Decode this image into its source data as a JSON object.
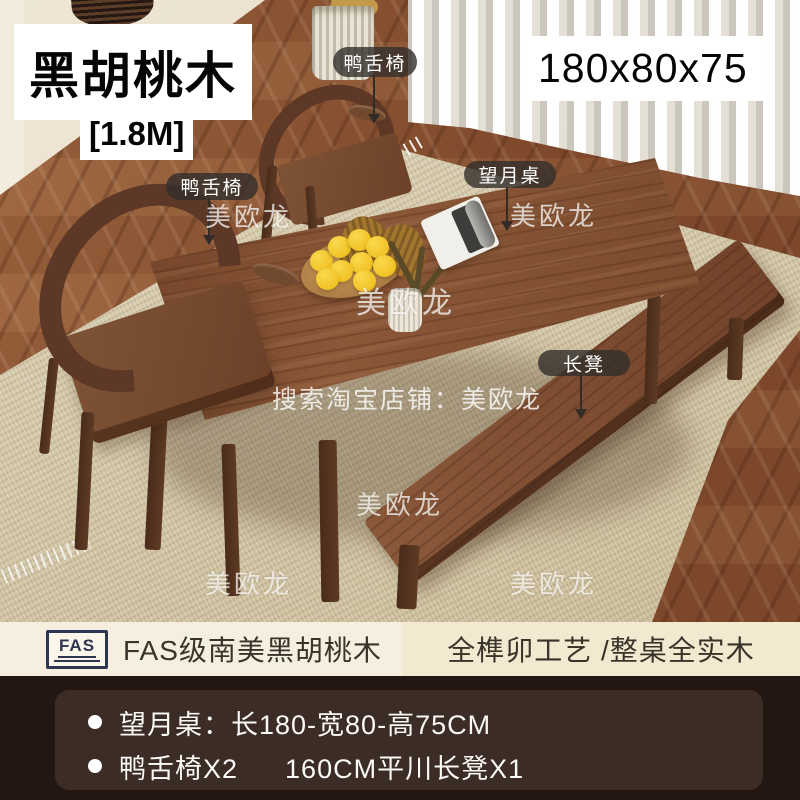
{
  "overlay": {
    "title": "黑胡桃木",
    "size_tag": "[1.8M]",
    "dimensions": "180x80x75",
    "callouts": {
      "chair_back": "鸭舌椅",
      "chair_front": "鸭舌椅",
      "table": "望月桌",
      "bench": "长凳"
    },
    "watermark": "美欧龙",
    "search_watermark": "搜索淘宝店铺：美欧龙"
  },
  "banner": {
    "logo": "FAS",
    "material": "FAS级南美黑胡桃木",
    "craft": "全榫卯工艺 /整桌全实木"
  },
  "specs": {
    "table_line": "望月桌：长180-宽80-高75CM",
    "chair_item": "鸭舌椅X2",
    "bench_item": "160CM平川长凳X1"
  },
  "colors": {
    "walnut": "#7c4c2f",
    "floor": "#8a573a",
    "rug": "#d3c7aa",
    "wall": "#e8e0cd",
    "banner_left_bg": "#f6eede",
    "banner_right_bg": "#f2e9d0",
    "logo_navy": "#2d3552",
    "bottom_bg": "#241610",
    "panel_bg": "#3b2c26",
    "lemon": "#f2c01e"
  }
}
